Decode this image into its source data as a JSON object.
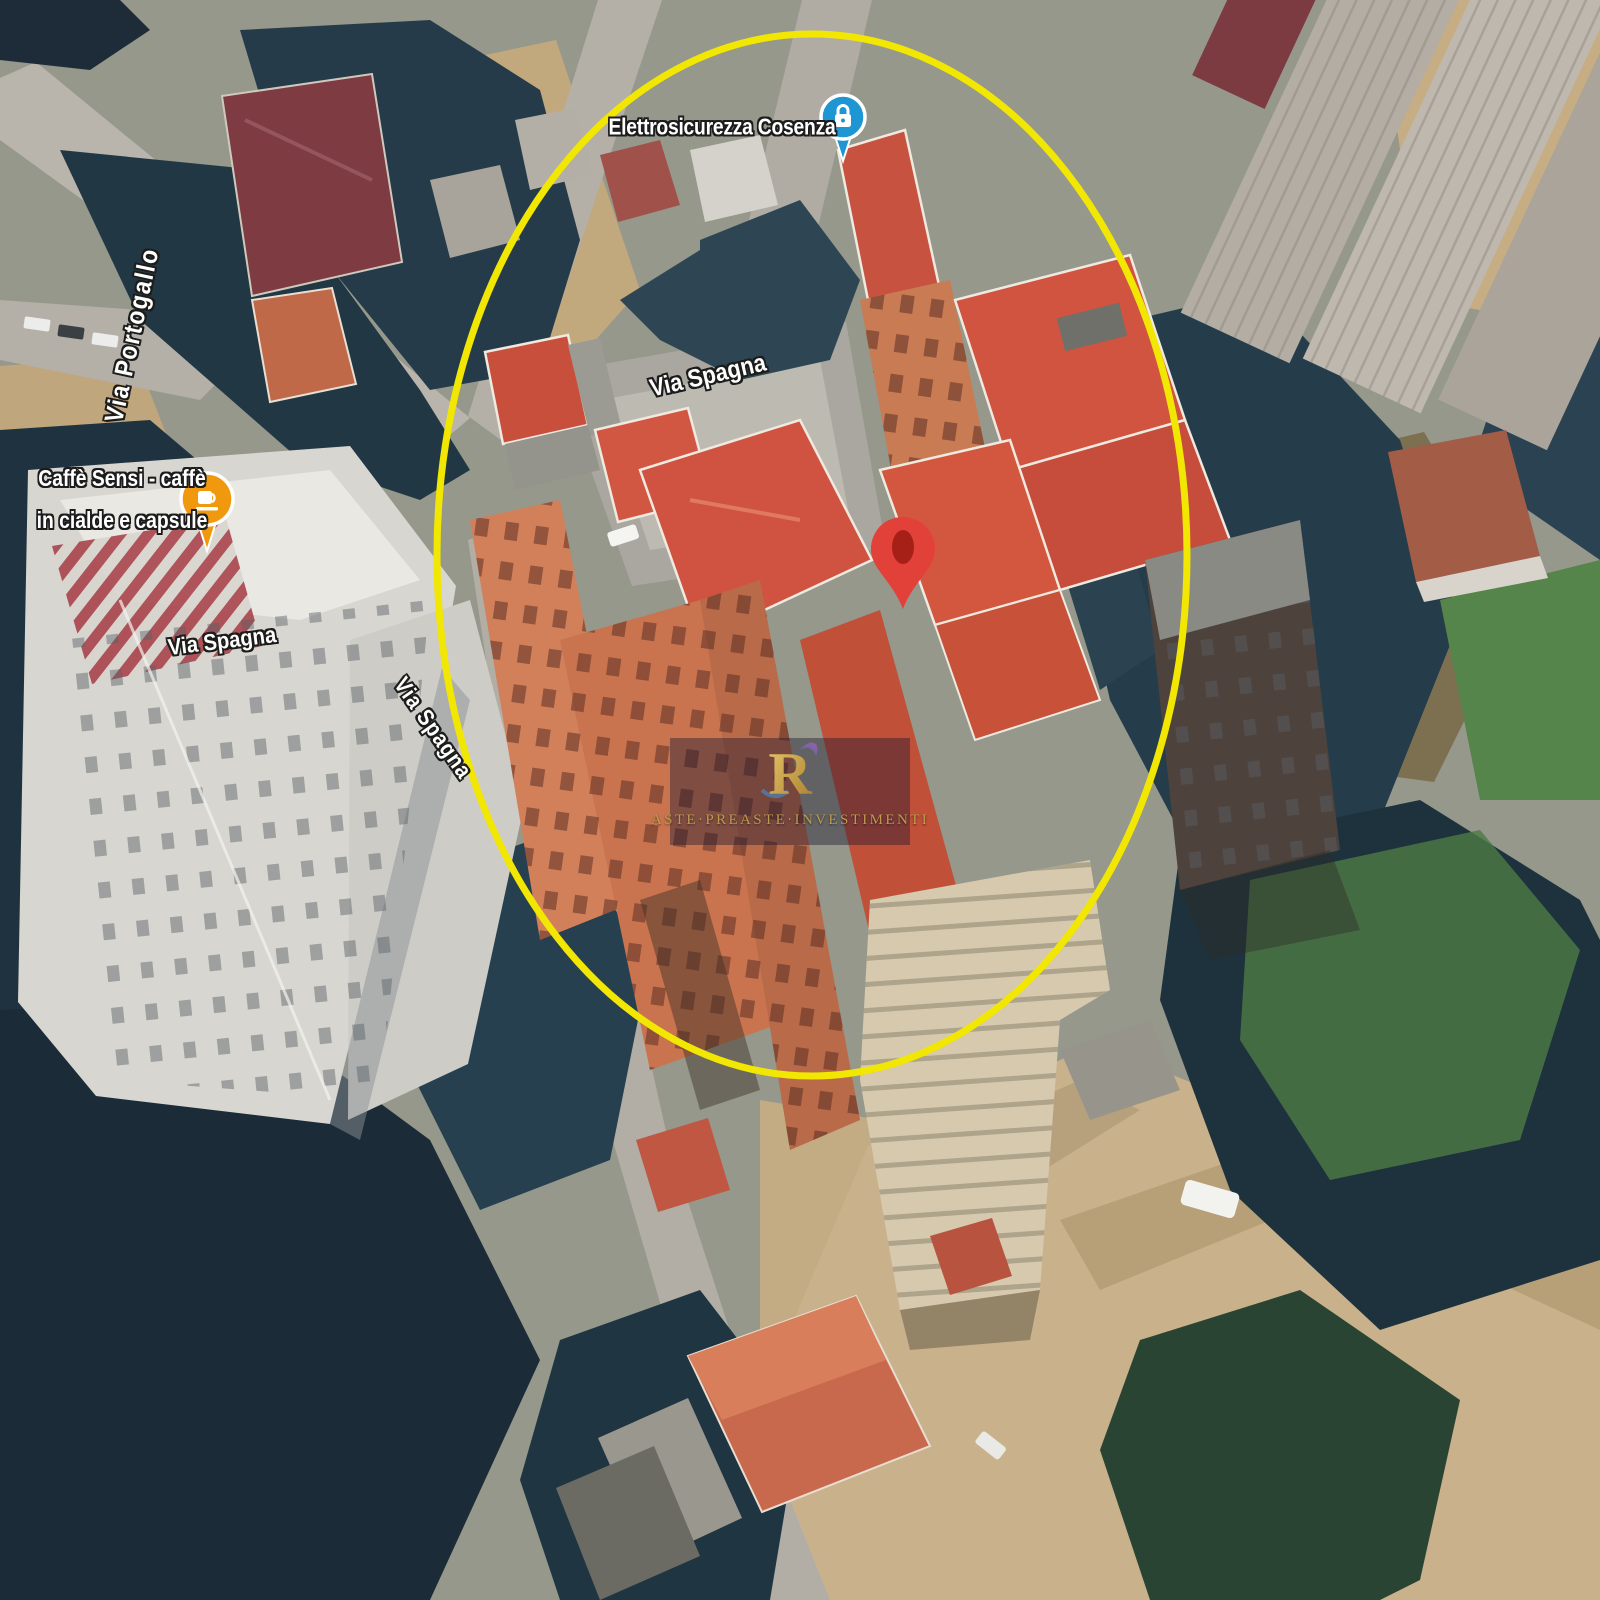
{
  "map": {
    "view": "3D satellite aerial view",
    "streets": {
      "portogallo": "Via Portogallo",
      "spagna_a": "Via Spagna",
      "spagna_b": "Via Spagna",
      "spagna_c": "Via Spagna"
    },
    "poi_store": {
      "label": "Elettrosicurezza Cosenza",
      "marker_color": "#1e96d3",
      "icon": "lock"
    },
    "poi_cafe": {
      "label_line1": "Caffè Sensi - caffè",
      "label_line2": "in cialde e capsule",
      "marker_color": "#f0990f",
      "icon": "coffee-cup"
    },
    "highlight": {
      "shape": "ellipse",
      "color": "#f2e702"
    },
    "pin": {
      "color": "#e2413a"
    }
  },
  "watermark": {
    "caption": "ASTE·PREASTE·INVESTIMENTI"
  }
}
